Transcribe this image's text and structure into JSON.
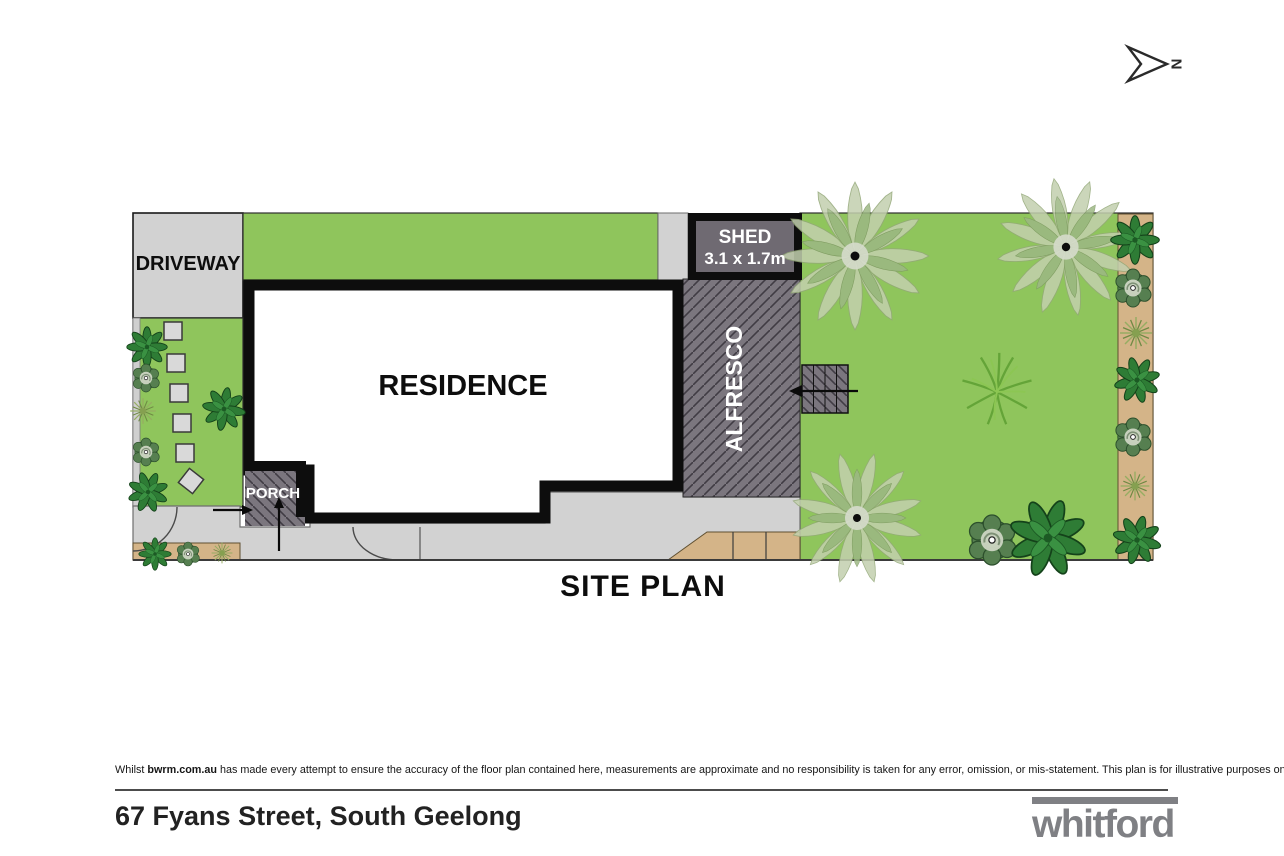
{
  "north": {
    "label": "N"
  },
  "plan": {
    "title": "SITE PLAN",
    "labels": {
      "driveway": "DRIVEWAY",
      "residence": "RESIDENCE",
      "alfresco": "ALFRESCO",
      "porch": "PORCH",
      "shed_line1": "SHED",
      "shed_line2": "3.1 x 1.7m"
    }
  },
  "footer": {
    "disclaimer_prefix": "Whilst ",
    "disclaimer_brand": "bwrm.com.au",
    "disclaimer_rest": " has made every attempt to ensure the accuracy of the floor plan contained here, measurements are approximate and no responsibility is taken for any error, omission, or mis-statement. This plan is for illustrative purposes only.",
    "address": "67 Fyans Street, South Geelong",
    "brand": "whitford"
  },
  "colors": {
    "lawn": "#8fc55c",
    "paving": "#d2d2d2",
    "tan": "#d4b488",
    "structure_gray": "#7b767e",
    "shed_gray": "#6f6a72",
    "wall_black": "#0d0d0d",
    "brand_gray": "#7f8084"
  }
}
